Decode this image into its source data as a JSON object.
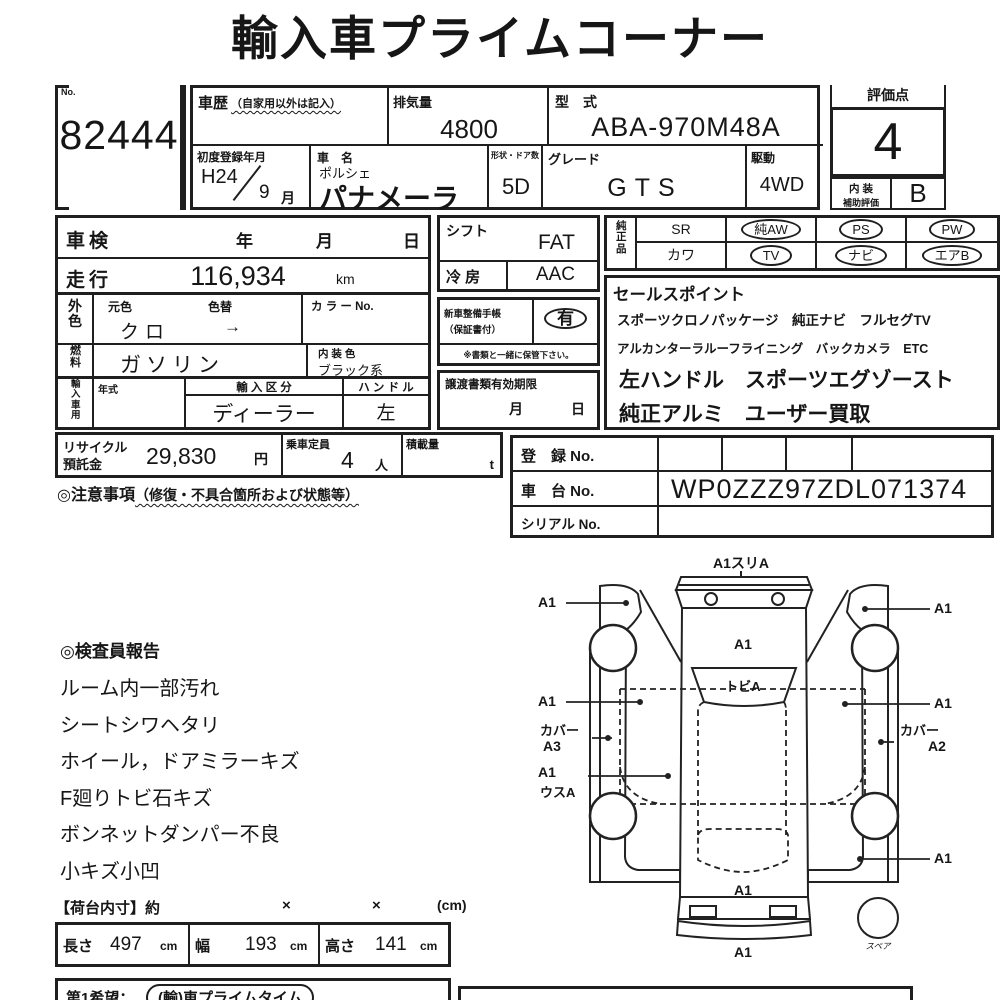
{
  "title": "輸入車プライムコーナー",
  "lot": {
    "no_label": "No.",
    "number": "82444"
  },
  "top": {
    "history_label": "車歴",
    "history_note": "（自家用以外は記入）",
    "displacement_label": "排気量",
    "displacement": "4800",
    "model_code_label": "型　式",
    "model_code": "ABA-970M48A",
    "first_reg_label": "初度登録年月",
    "first_reg_year": "H24",
    "first_reg_month": "9",
    "first_reg_month_unit": "月",
    "car_name_label": "車　名",
    "car_maker": "ポルシェ",
    "car_name": "パナメーラ",
    "shape_label": "形状・ドア数",
    "shape": "5D",
    "grade_label": "グレード",
    "grade": "GTS",
    "drive_label": "駆動",
    "drive": "4WD"
  },
  "rating": {
    "label": "評価点",
    "score": "4",
    "interior_label_1": "内 装",
    "interior_label_2": "補助評価",
    "interior_score": "B"
  },
  "left_table": {
    "shaken_label": "車検",
    "year": "年",
    "month": "月",
    "day": "日",
    "mileage_label": "走行",
    "mileage": "116,934",
    "mileage_unit": "km",
    "ext_color_label": "外色",
    "base_color_label": "元色",
    "base_color": "クロ",
    "repaint_label": "色替",
    "repaint": "→",
    "color_no_label": "カ ラ ー No.",
    "fuel_label": "燃料",
    "fuel": "ガソリン",
    "interior_color_label": "内 装 色",
    "interior_color": "ブラック系",
    "import_label": "輸入車用",
    "model_year_label": "年式",
    "import_class_label": "輸 入 区 分",
    "import_class": "ディーラー",
    "handle_label": "ハ ン ド ル",
    "handle": "左"
  },
  "shift_box": {
    "shift_label": "シフト",
    "shift": "FAT",
    "ac_label": "冷 房",
    "ac": "AAC",
    "service_label_1": "新車整備手帳",
    "service_label_2": "（保証書付）",
    "service_value": "有",
    "service_note": "※書類と一緒に保管下さい。",
    "transfer_label": "譲渡書類有効期限",
    "transfer_month": "月",
    "transfer_day": "日"
  },
  "genuine": {
    "label": "純正品",
    "rows": [
      [
        "SR",
        "純AW",
        "PS",
        "PW"
      ],
      [
        "カワ",
        "TV",
        "ナビ",
        "エアB"
      ]
    ],
    "circled": [
      [
        false,
        true,
        true,
        true
      ],
      [
        false,
        true,
        true,
        true
      ]
    ]
  },
  "sales": {
    "label": "セールスポイント",
    "lines": [
      "スポーツクロノパッケージ　純正ナビ　フルセグTV",
      "アルカンターラルーフライニング　バックカメラ　ETC",
      "左ハンドル　スポーツエグゾースト",
      "純正アルミ　ユーザー買取"
    ]
  },
  "recycle": {
    "label_1": "リサイクル",
    "label_2": "預託金",
    "value": "29,830",
    "unit": "円",
    "capacity_label": "乗車定員",
    "capacity": "4",
    "capacity_unit": "人",
    "load_label": "積載量",
    "load_unit": "t"
  },
  "caution": {
    "heading": "◎注意事項",
    "heading_note": "（修復・不具合箇所および状態等）"
  },
  "registration": {
    "reg_label": "登　録 No.",
    "chassis_label": "車　台 No.",
    "chassis": "WP0ZZZ97ZDL071374",
    "serial_label": "シリアル No."
  },
  "report": {
    "heading": "◎検査員報告",
    "items": [
      "ルーム内一部汚れ",
      "シートシワヘタリ",
      "ホイール，ドアミラーキズ",
      "F廻りトビ石キズ",
      "ボンネットダンパー不良",
      "小キズ小凹"
    ]
  },
  "diagram": {
    "front": "A1スリA",
    "hood": "A1",
    "windshield": "トビA",
    "left_front": "A1",
    "right_front": "A1",
    "left_door": "A1",
    "right_door": "A1",
    "left_cover": "カバー",
    "left_cover_code": "A3",
    "right_cover": "カバー",
    "right_cover_code": "A2",
    "left_rear": "A1",
    "left_rear_code": "ウスA",
    "right_rear": "A1",
    "trunk": "A1",
    "rear": "A1",
    "spare": "スペア"
  },
  "cargo": {
    "heading": "【荷台内寸】約",
    "x1": "×",
    "x2": "×",
    "unit_note": "(cm)",
    "length_label": "長さ",
    "length": "497",
    "length_unit": "cm",
    "width_label": "幅",
    "width": "193",
    "width_unit": "cm",
    "height_label": "高さ",
    "height": "141",
    "height_unit": "cm"
  },
  "bottom": {
    "wish_label": "第1希望：",
    "wish_value": "(輸)車プライムタイム"
  }
}
